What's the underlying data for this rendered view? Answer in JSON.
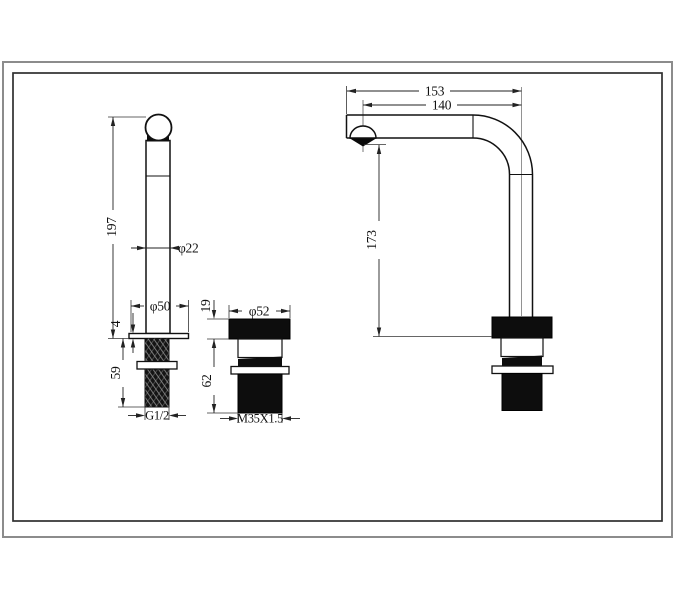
{
  "dimensions": {
    "handle": {
      "overall_height": "197",
      "body_diameter": "φ22",
      "base_diameter": "φ50",
      "base_thickness": "4",
      "shank_length": "59",
      "thread": "G1/2"
    },
    "cartridge": {
      "cap_height": "19",
      "cap_diameter": "φ52",
      "body_height": "62",
      "thread": "M35X1.5"
    },
    "spout": {
      "overall_reach": "153",
      "outlet_reach": "140",
      "outlet_height": "173"
    }
  },
  "colors": {
    "line": "#111111",
    "fill_black": "#0d0d0d",
    "border_outer": "#8c8c8c",
    "border_inner": "#2f2f2f"
  }
}
